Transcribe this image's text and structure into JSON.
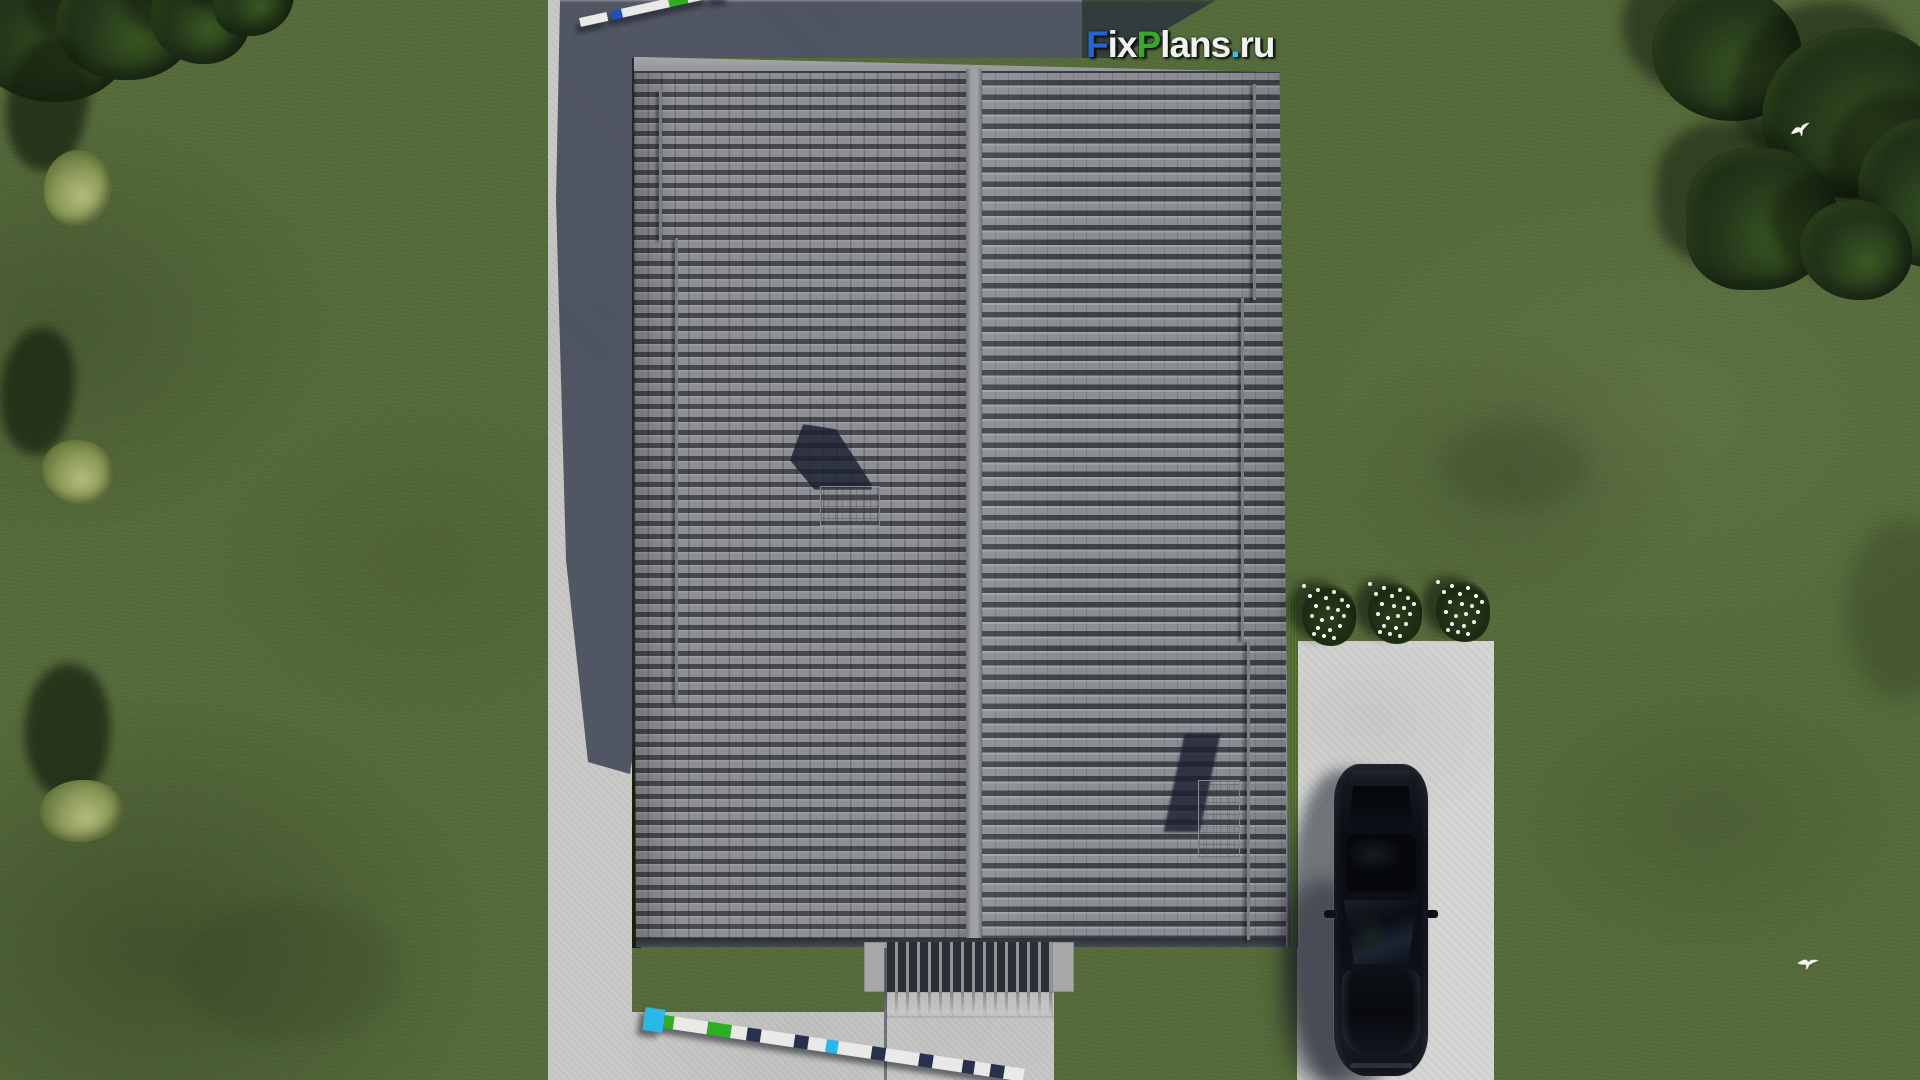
{
  "logo": {
    "text": "FixPlans.ru",
    "letters": [
      {
        "ch": "F",
        "style": "color:#2764cf"
      },
      {
        "ch": "i",
        "style": "color:#f2f2f2"
      },
      {
        "ch": "x",
        "style": "color:#f2f2f2"
      },
      {
        "ch": "P",
        "style": "color:#39a92b"
      },
      {
        "ch": "l",
        "style": "color:#f2f2f2"
      },
      {
        "ch": "a",
        "style": "color:#f2f2f2"
      },
      {
        "ch": "n",
        "style": "color:#f2f2f2"
      },
      {
        "ch": "s",
        "style": "color:#f2f2f2"
      },
      {
        "ch": ".",
        "style": "color:#2fc3ef"
      },
      {
        "ch": "r",
        "style": "color:#f2f2f2"
      },
      {
        "ch": "u",
        "style": "color:#f2f2f2"
      }
    ]
  },
  "scene": {
    "description": "Top-down aerial 3D render of a house plan: large gray tiled gable roof with ridge and two chimneys, lawn with trees and bushes, concrete walkways, entrance porch with louvers, driveway with parked black car, three white flower bushes, two flying white birds, and two colored surveying scale bars",
    "palette": {
      "grass": "#556b3a",
      "tree": "#24381b",
      "bush": "#8e9c5b",
      "roof_tile": "#84878d",
      "roof_ridge": "#a0a2a6",
      "roof_fascia": "#474b52",
      "concrete": "#c9c9c7",
      "driveway": "#d5d5d3",
      "building_shadow": "rgba(36,43,62,0.72)",
      "car": "#0b0e13",
      "flowers_white": "#f5f5f0",
      "marker_white": "#e9e9e7",
      "marker_blue": "#1d53b8",
      "marker_green": "#2fae24",
      "marker_cyan": "#2bb7e8",
      "marker_navy": "#27314e",
      "gap": "transparent"
    },
    "objects": {
      "roof": {
        "label": "gray tiled gable roof, ridge vertical, 2 chimneys, rain pipes"
      },
      "car": {
        "label": "black car parked on driveway, top view",
        "count": 1
      },
      "flower_bushes": {
        "count": 3
      },
      "birds": {
        "count": 2
      },
      "survey_markers": {
        "count": 2
      },
      "tree_clusters": {
        "count": 2
      },
      "light_bushes": {
        "count": 3
      }
    },
    "markers": {
      "top": {
        "x": 580,
        "y": 18,
        "angle": -12.5,
        "segments": [
          {
            "w": 15,
            "c": "marker_white"
          },
          {
            "w": 13,
            "c": "marker_white"
          },
          {
            "w": 4,
            "c": "gap"
          },
          {
            "w": 11,
            "c": "marker_blue"
          },
          {
            "w": 14,
            "c": "marker_white"
          },
          {
            "w": 13,
            "c": "marker_white"
          },
          {
            "w": 14,
            "c": "marker_white"
          },
          {
            "w": 7,
            "c": "marker_white"
          },
          {
            "w": 19,
            "c": "marker_green"
          },
          {
            "w": 13,
            "c": "marker_white"
          },
          {
            "w": 8,
            "c": "marker_green"
          },
          {
            "w": 4,
            "c": "gap"
          },
          {
            "w": 17,
            "c": "marker_blue",
            "big": true
          }
        ]
      },
      "bottom": {
        "x": 644,
        "y": 1012,
        "angle": 8.5,
        "segments": [
          {
            "w": 20,
            "c": "marker_cyan",
            "big": true
          },
          {
            "w": 10,
            "c": "marker_green"
          },
          {
            "w": 18,
            "c": "marker_white"
          },
          {
            "w": 16,
            "c": "marker_white"
          },
          {
            "w": 24,
            "c": "marker_green"
          },
          {
            "w": 16,
            "c": "marker_white"
          },
          {
            "w": 14,
            "c": "marker_navy"
          },
          {
            "w": 18,
            "c": "marker_white"
          },
          {
            "w": 16,
            "c": "marker_white"
          },
          {
            "w": 14,
            "c": "marker_navy"
          },
          {
            "w": 18,
            "c": "marker_white"
          },
          {
            "w": 12,
            "c": "marker_cyan"
          },
          {
            "w": 18,
            "c": "marker_white"
          },
          {
            "w": 16,
            "c": "marker_white"
          },
          {
            "w": 14,
            "c": "marker_navy"
          },
          {
            "w": 18,
            "c": "marker_white"
          },
          {
            "w": 16,
            "c": "marker_white"
          },
          {
            "w": 14,
            "c": "marker_navy"
          },
          {
            "w": 16,
            "c": "marker_white"
          },
          {
            "w": 14,
            "c": "marker_white"
          },
          {
            "w": 12,
            "c": "marker_navy"
          },
          {
            "w": 16,
            "c": "marker_white"
          },
          {
            "w": 14,
            "c": "marker_navy"
          },
          {
            "w": 20,
            "c": "marker_white"
          }
        ]
      }
    }
  }
}
